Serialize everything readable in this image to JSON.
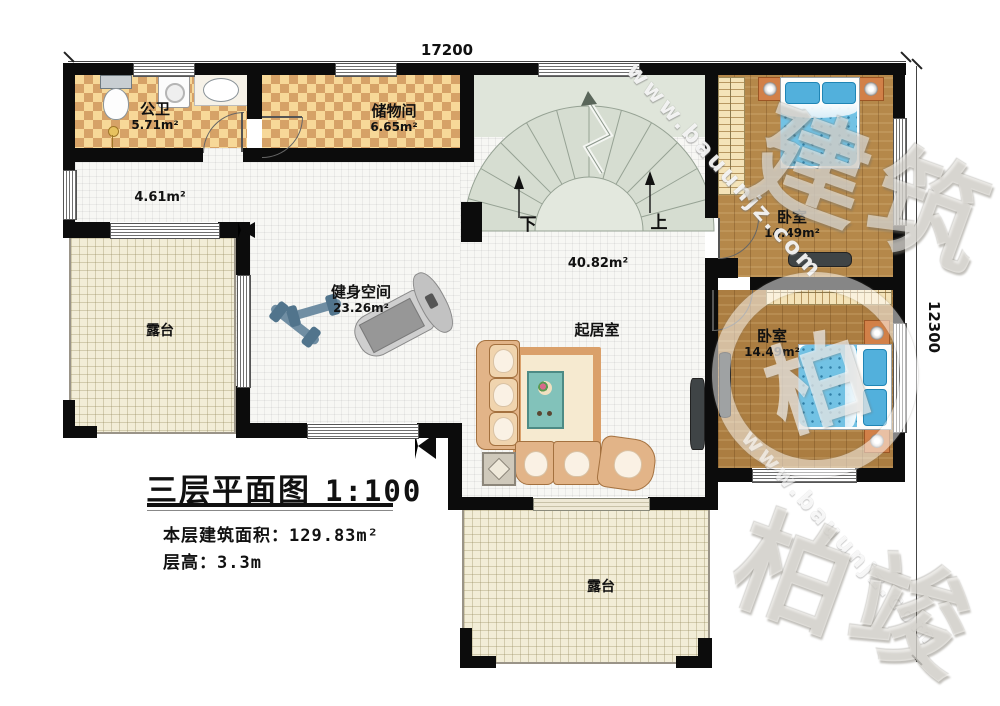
{
  "dimensions": {
    "top_width": "17200",
    "right_height": "12300"
  },
  "title_block": {
    "title": "三层平面图",
    "scale": "1:100",
    "area_label": "本层建筑面积：",
    "area_value": "129.83m²",
    "floor_height_label": "层高：",
    "floor_height_value": "3.3m"
  },
  "rooms": {
    "bathroom": {
      "name": "公卫",
      "area": "5.71m²"
    },
    "storage": {
      "name": "储物间",
      "area": "6.65m²"
    },
    "hallway": {
      "area": "4.61m²"
    },
    "main_hall": {
      "area": "40.82m²"
    },
    "fitness": {
      "name": "健身空间",
      "area": "23.26m²"
    },
    "living_room": {
      "name": "起居室"
    },
    "bedroom_top": {
      "name": "卧室",
      "area": "14.49m²"
    },
    "bedroom_bottom": {
      "name": "卧室",
      "area": "14.49m²"
    },
    "terrace_left": {
      "name": "露台"
    },
    "terrace_bottom": {
      "name": "露台"
    }
  },
  "stairs": {
    "down_label": "下",
    "up_label": "上"
  },
  "watermark": {
    "site": "www.bauunjz.com",
    "brand": "柏竣建筑",
    "brand_fragment_top": "建筑",
    "brand_fragment_bottom": "柏竣",
    "emblem": "柏"
  },
  "colors": {
    "wall": "#0c0c0c",
    "tile_light": "#f7d898",
    "tile_dark": "#d6a267",
    "wood": "#b5884a",
    "terrace": "#f2edd7",
    "stair": "#d6ddd1",
    "bed_blue": "#72c2e4",
    "sofa_tan": "#f0d4ae"
  }
}
